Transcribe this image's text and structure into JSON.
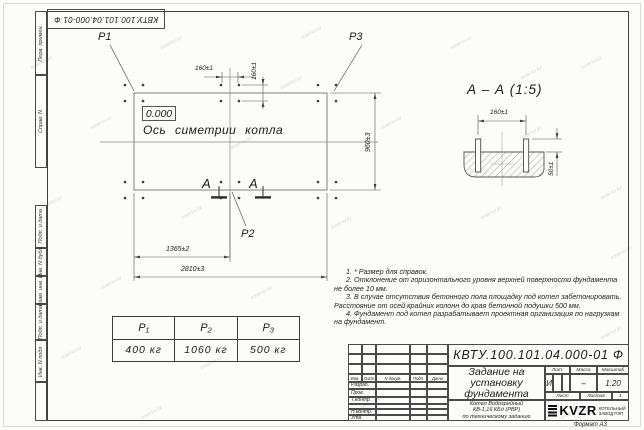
{
  "watermark_text": "kotel-kv.kz",
  "stamp": {
    "designation_rotated": "КВТУ.100.101.04.000-01  Ф"
  },
  "margin_column": {
    "labels": [
      "Перв. примен.",
      "Справ. N",
      "Подп. и дата",
      "Инв. N дубл.",
      "Взам. инв. N",
      "Подп. и дата",
      "Инв. N подл."
    ]
  },
  "plan": {
    "p1_label": "P1",
    "p2_label": "P2",
    "p3_label": "P3",
    "elevation_mark": "0.000",
    "axis_label": "Ось симетрии котла",
    "section_letter_left": "А",
    "section_letter_right": "А",
    "dims": {
      "bolt_spacing_x": "160±1",
      "bolt_spacing_y": "160±1",
      "to_center": "1365±2",
      "total_length": "2810±3",
      "total_width": "960±3"
    }
  },
  "section_view": {
    "title": "А – А (1:5)",
    "dim_width": "160±1",
    "dim_height": "50±1"
  },
  "loads_table": {
    "headers": [
      "P₁",
      "P₂",
      "P₃"
    ],
    "values": [
      "400 кг",
      "1060 кг",
      "500 кг"
    ]
  },
  "notes": [
    "1. * Размер для справок.",
    "2. Отклонение от горизонтального уровня верхней поверхности фундамента не более 10 мм.",
    "3. В случае отсутствия бетонного пола площадку под котел забетонировать. Расстояние от осей крайних колонн до края бетонной подушки 500 мм.",
    "4. Фундамент под котел разрабатывает проектная организация по нагрузкам на фундамент."
  ],
  "title_block": {
    "designation": "КВТУ.100.101.04.000-01  Ф",
    "doc_title_lines": [
      "Задание на",
      "установку",
      "фундамента"
    ],
    "subtitle_lines": [
      "Котел Водогрейный",
      "КВ-1,16 КБд (РВР)",
      "по техническому заданию"
    ],
    "header_cols": [
      "Изм.",
      "Лист",
      "N докум.",
      "Подп.",
      "Дата"
    ],
    "row_labels": [
      "Разраб.",
      "Пров.",
      "Т.контр.",
      "Н.контр.",
      "Утв."
    ],
    "lit_label": "Лит.",
    "lit_value": "И",
    "mass_label": "Масса",
    "mass_value": "–",
    "scale_label": "Масштаб",
    "scale_value": "1:20",
    "sheet_label": "Лист",
    "sheets_label": "Листов",
    "sheets_value": "1",
    "logo_text": "KVZR",
    "logo_caption_line1": "КОТЕЛЬНЫЙ",
    "logo_caption_line2": "ЗАВОД РЭП",
    "format_label": "Формат А3"
  }
}
